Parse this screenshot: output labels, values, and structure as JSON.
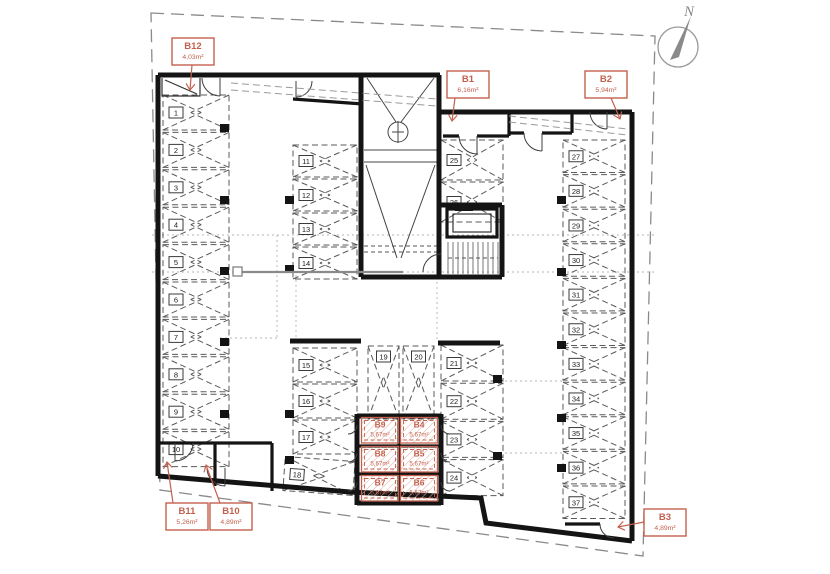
{
  "plan": {
    "north_label": "N",
    "colors": {
      "accent": "#c4614e",
      "wall": "#141414"
    },
    "parking_spaces": [
      "1",
      "2",
      "3",
      "4",
      "5",
      "6",
      "7",
      "8",
      "9",
      "10",
      "11",
      "12",
      "13",
      "14",
      "15",
      "16",
      "17",
      "18",
      "19",
      "20",
      "21",
      "22",
      "23",
      "24",
      "25",
      "26",
      "27",
      "28",
      "29",
      "30",
      "31",
      "32",
      "33",
      "34",
      "35",
      "36",
      "37"
    ],
    "storage_units": [
      {
        "id": "B1",
        "area": "6,16m²"
      },
      {
        "id": "B2",
        "area": "5,94m²"
      },
      {
        "id": "B3",
        "area": "4,89m²"
      },
      {
        "id": "B4",
        "area": "5,67m²"
      },
      {
        "id": "B5",
        "area": "5,67m²"
      },
      {
        "id": "B6",
        "area": "5,67m²"
      },
      {
        "id": "B7",
        "area": "5,67m²"
      },
      {
        "id": "B8",
        "area": "5,67m²"
      },
      {
        "id": "B9",
        "area": "5,67m²"
      },
      {
        "id": "B10",
        "area": "4,89m²"
      },
      {
        "id": "B11",
        "area": "5,26m²"
      },
      {
        "id": "B12",
        "area": "4,03m²"
      }
    ]
  }
}
